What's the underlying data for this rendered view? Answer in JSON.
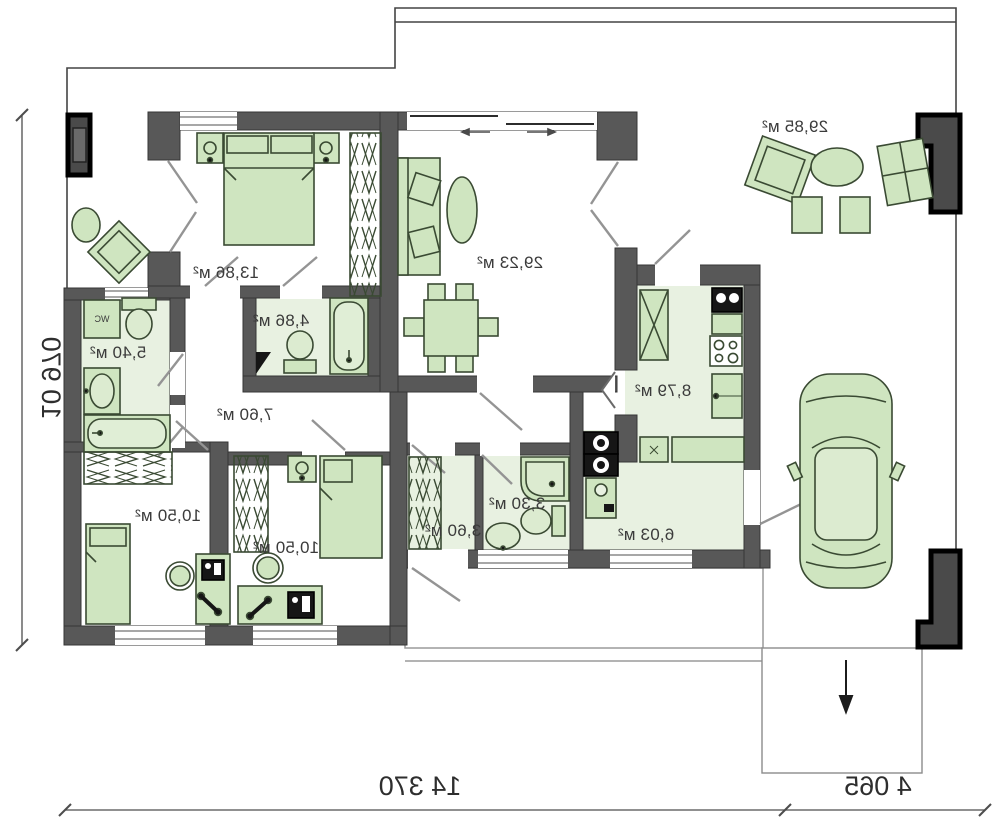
{
  "plan": {
    "type": "single-storey house floor plan (mirrored print)",
    "rooms": [
      {
        "id": "bedroom-main",
        "area": "13,86 м²"
      },
      {
        "id": "bathroom-main",
        "area": "4,86 м²"
      },
      {
        "id": "living-room",
        "area": "29,23 м²"
      },
      {
        "id": "toilet-room",
        "area": "5,40 м²"
      },
      {
        "id": "hall",
        "area": "7,60 м²"
      },
      {
        "id": "bedroom-1",
        "area": "10,50 м²"
      },
      {
        "id": "bedroom-2",
        "area": "10,50 м²"
      },
      {
        "id": "entry",
        "area": "3,60 м²"
      },
      {
        "id": "bathroom-2",
        "area": "3,30 м²"
      },
      {
        "id": "utility",
        "area": "6,03 м²"
      },
      {
        "id": "kitchen",
        "area": "8,79 м²"
      },
      {
        "id": "terrace",
        "area": "29,85 м²"
      }
    ],
    "fixture_labels": {
      "wc": "WC"
    },
    "dimensions": {
      "left": "10 970",
      "bottom": "14 370",
      "bottom_right": "4 065"
    },
    "colors": {
      "wall": "#585858",
      "wall_edge": "#363636",
      "furniture_fill": "#cfe5c0",
      "furniture_stroke": "#3a4a33",
      "wet_floor": "#e8f1e1",
      "black_fixture": "#161616",
      "swing_line": "#949494",
      "boundary": "#444444"
    }
  }
}
